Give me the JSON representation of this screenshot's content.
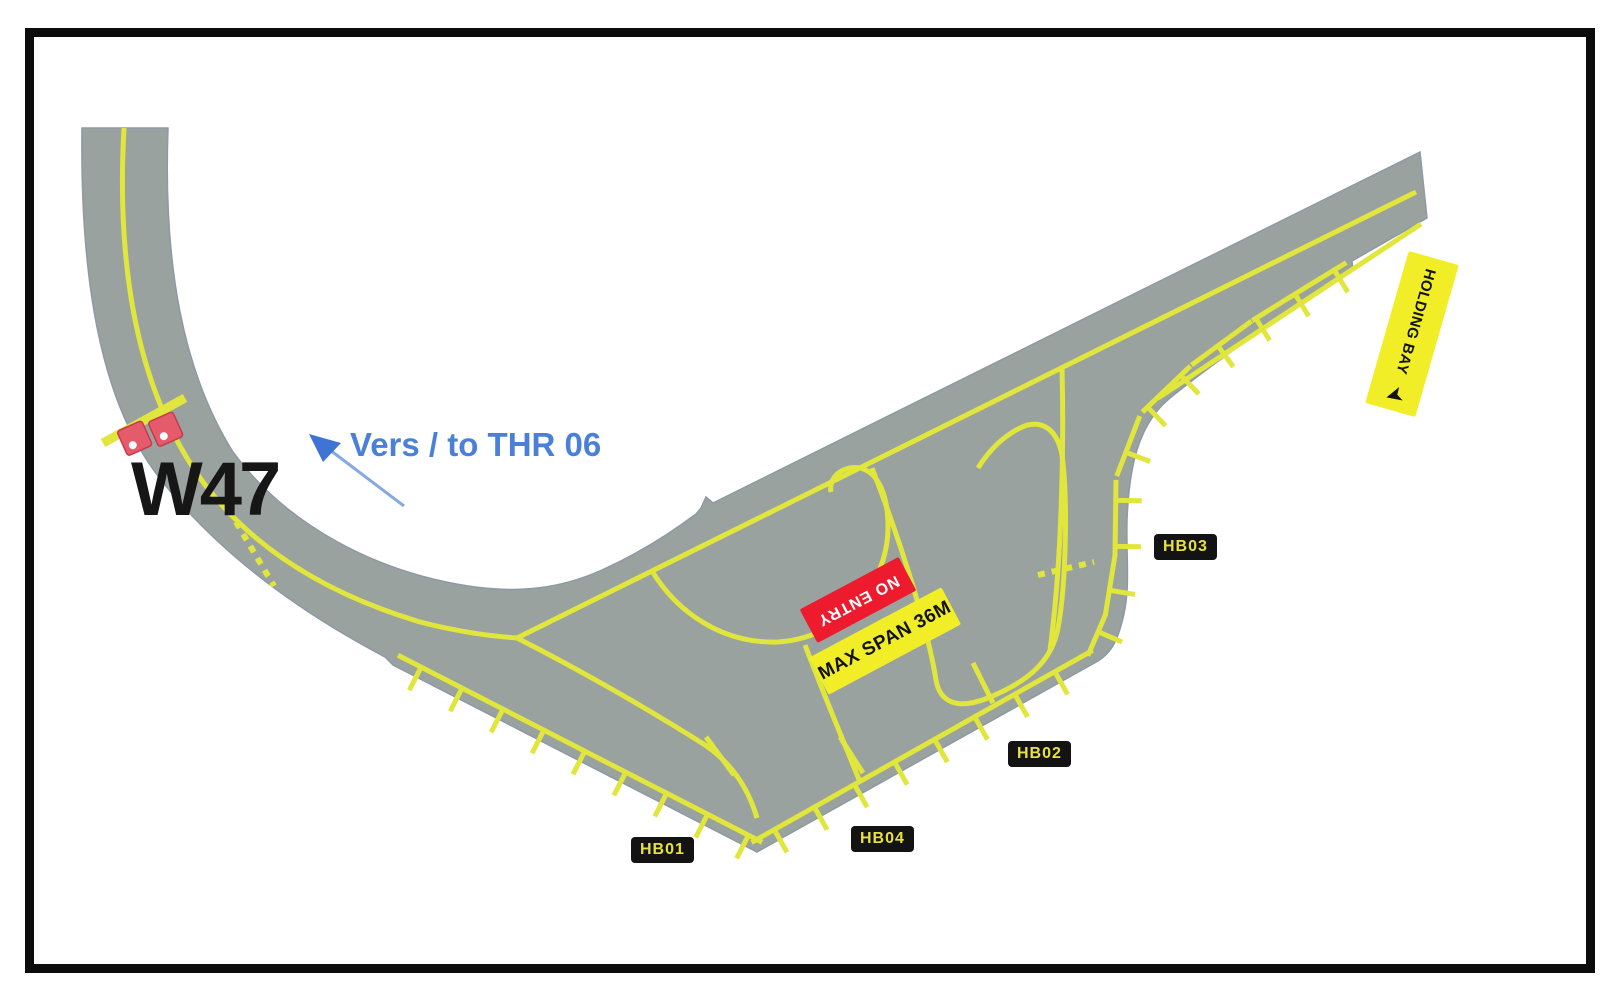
{
  "diagram": {
    "taxiway_label": "W47",
    "direction_note": "Vers / to THR 06",
    "signs": {
      "no_entry": "NO ENTRY",
      "max_span": "MAX SPAN 36M",
      "holding_bay": "HOLDING BAY"
    },
    "holding_points": {
      "hb01": "HB01",
      "hb02": "HB02",
      "hb03": "HB03",
      "hb04": "HB04"
    },
    "icons": {
      "holding_bay_arrow": "➤"
    },
    "colors": {
      "pavement": "#9aa2a0",
      "marking_yellow": "#e1e63c",
      "sign_red": "#ee1b2e",
      "sign_yellow": "#f1ee27",
      "label_bg": "#131313",
      "label_text": "#e8e23c",
      "note_blue": "#4a80d8",
      "stopbar_light_red": "#e55b6b",
      "frame_black": "#0c0c0c"
    }
  }
}
